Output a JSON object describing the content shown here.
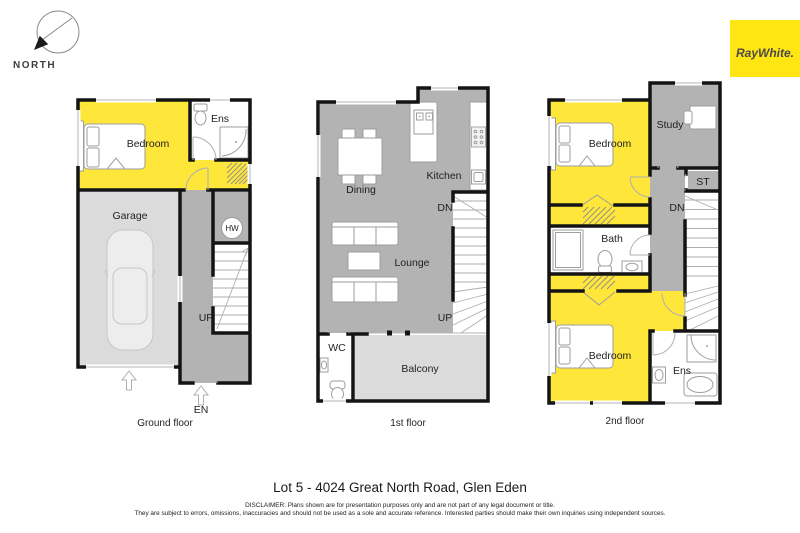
{
  "compass": {
    "label": "NORTH"
  },
  "brand": {
    "name": "RayWhite."
  },
  "floors": {
    "ground": {
      "caption": "Ground floor",
      "labels": {
        "bedroom": "Bedroom",
        "ens": "Ens",
        "garage": "Garage",
        "hw": "HW",
        "up": "UP",
        "en": "EN"
      }
    },
    "first": {
      "caption": "1st floor",
      "labels": {
        "dining": "Dining",
        "kitchen": "Kitchen",
        "lounge": "Lounge",
        "dn": "DN",
        "up": "UP",
        "wc": "WC",
        "balcony": "Balcony"
      }
    },
    "second": {
      "caption": "2nd floor",
      "labels": {
        "bedroom_front": "Bedroom",
        "study": "Study",
        "st": "ST",
        "dn": "DN",
        "bath": "Bath",
        "bedroom_rear": "Bedroom",
        "ens": "Ens"
      }
    }
  },
  "footer": {
    "title": "Lot 5 - 4024 Great North Road, Glen Eden",
    "disclaimer1": "DISCLAIMER: Plans shown are for presentation purposes only and are not part of any legal document or title.",
    "disclaimer2": "They are subject to errors, omissions, inaccuracies and should not be used as a sole and accurate reference. Interested parties should make their own inquiries using independent sources."
  },
  "colors": {
    "room_yellow": "#ffe63a",
    "brand_yellow": "#ffe512",
    "mid_gray": "#b3b3b3",
    "light_gray": "#dbdbdb",
    "wall": "#141414"
  }
}
